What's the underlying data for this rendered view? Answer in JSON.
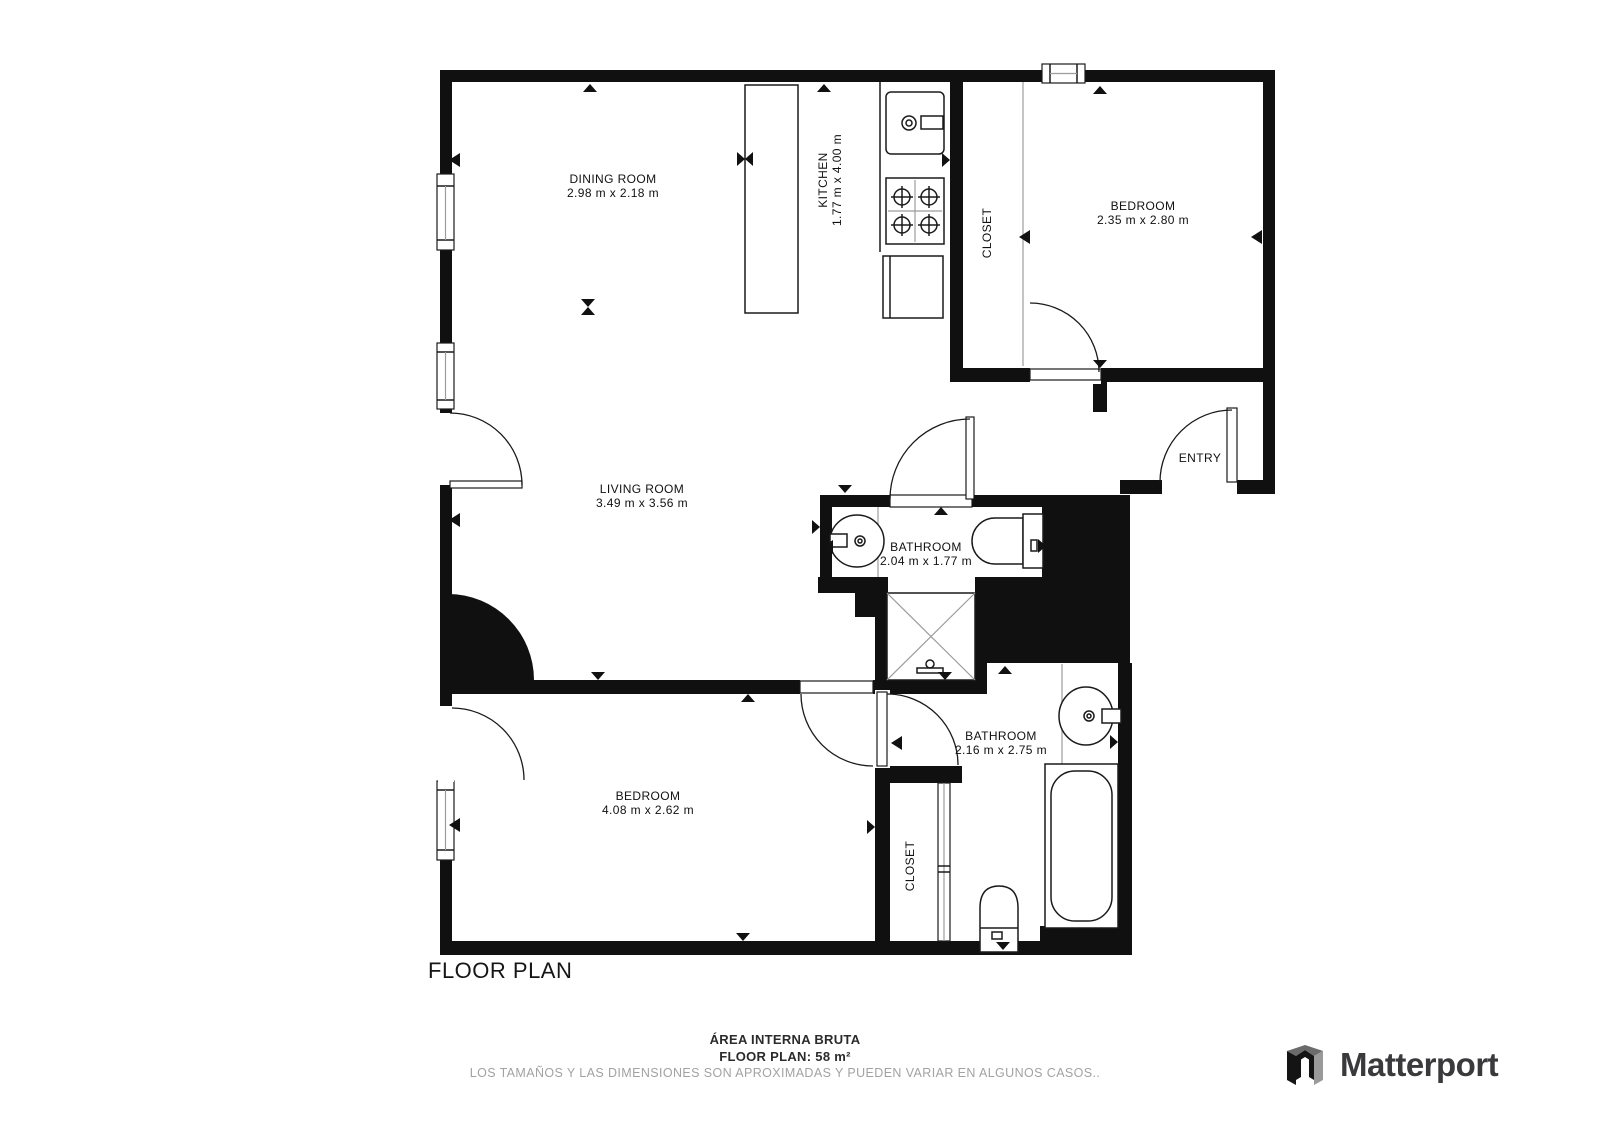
{
  "page": {
    "title_heading": "FLOOR PLAN"
  },
  "footer": {
    "area_label": "ÁREA INTERNA BRUTA",
    "area_value": "FLOOR PLAN: 58 m²",
    "disclaimer": "LOS TAMAÑOS Y LAS DIMENSIONES SON APROXIMADAS Y PUEDEN VARIAR EN ALGUNOS CASOS.."
  },
  "brand": {
    "name": "Matterport",
    "logo_icon": "matterport-m-mark"
  },
  "plan": {
    "marker_icon": "scan-direction-triangle",
    "colors": {
      "wall": "#101010",
      "line": "#1a1a1a",
      "divider": "#9c9c9c",
      "text": "#111111",
      "muted": "#a2a2a2",
      "logo_text": "#3a3a3c"
    },
    "rooms": [
      {
        "id": "dining-room",
        "label": "DINING ROOM",
        "dims": "2.98 m x 2.18 m",
        "x": 613,
        "y": 183,
        "rot": 0
      },
      {
        "id": "kitchen",
        "label": "KITCHEN",
        "dims": "1.77 m x 4.00 m",
        "x": 827,
        "y": 180,
        "rot": -90
      },
      {
        "id": "closet-top",
        "label": "CLOSET",
        "dims": "",
        "x": 991,
        "y": 233,
        "rot": -90
      },
      {
        "id": "bedroom-top",
        "label": "BEDROOM",
        "dims": "2.35 m x 2.80 m",
        "x": 1143,
        "y": 210,
        "rot": 0
      },
      {
        "id": "living-room",
        "label": "LIVING ROOM",
        "dims": "3.49 m x 3.56 m",
        "x": 642,
        "y": 493,
        "rot": 0
      },
      {
        "id": "entry",
        "label": "ENTRY",
        "dims": "",
        "x": 1200,
        "y": 462,
        "rot": 0
      },
      {
        "id": "bathroom-1",
        "label": "BATHROOM",
        "dims": "2.04 m x 1.77 m",
        "x": 926,
        "y": 551,
        "rot": 0
      },
      {
        "id": "bathroom-2",
        "label": "BATHROOM",
        "dims": "2.16 m x 2.75 m",
        "x": 1001,
        "y": 740,
        "rot": 0
      },
      {
        "id": "closet-bottom",
        "label": "CLOSET",
        "dims": "",
        "x": 914,
        "y": 866,
        "rot": -90
      },
      {
        "id": "bedroom-bottom",
        "label": "BEDROOM",
        "dims": "4.08 m x 2.62 m",
        "x": 648,
        "y": 800,
        "rot": 0
      }
    ]
  }
}
